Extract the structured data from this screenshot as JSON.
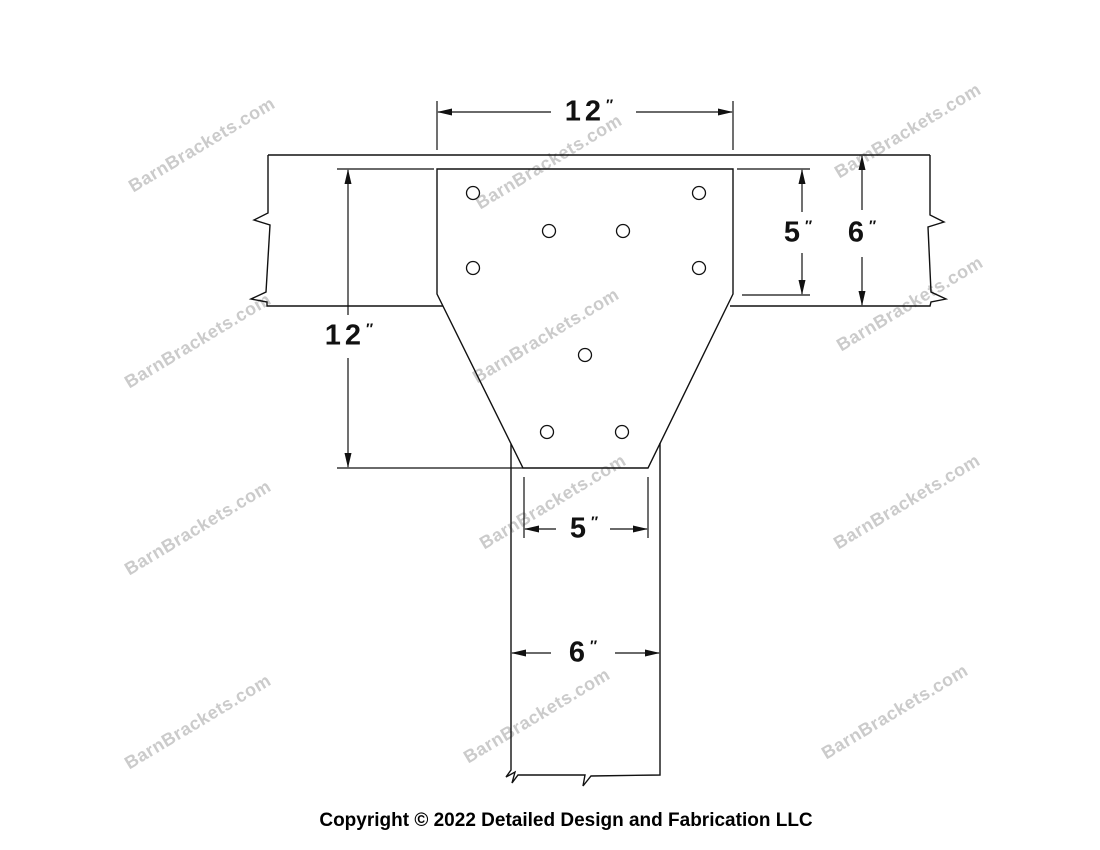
{
  "drawing": {
    "title_hint": "T-shaped barn bracket elevation drawing",
    "line_color": "#111111",
    "dimensions": {
      "top_width": {
        "value": "12",
        "unit": "″"
      },
      "left_height": {
        "value": "12",
        "unit": "″"
      },
      "right_plate_top": {
        "value": "5",
        "unit": "″"
      },
      "right_beam_height": {
        "value": "6",
        "unit": "″"
      },
      "bottom_plate_width": {
        "value": "5",
        "unit": "″"
      },
      "bottom_post_width": {
        "value": "6",
        "unit": "″"
      }
    },
    "holes": [
      {
        "x": 473,
        "y": 193
      },
      {
        "x": 699,
        "y": 193
      },
      {
        "x": 549,
        "y": 231
      },
      {
        "x": 623,
        "y": 231
      },
      {
        "x": 473,
        "y": 268
      },
      {
        "x": 699,
        "y": 268
      },
      {
        "x": 585,
        "y": 355
      },
      {
        "x": 547,
        "y": 432
      },
      {
        "x": 622,
        "y": 432
      }
    ]
  },
  "watermark": {
    "text": "BarnBrackets.com",
    "color": "#cbcbcb",
    "positions": [
      {
        "x": 202,
        "y": 145
      },
      {
        "x": 549,
        "y": 162
      },
      {
        "x": 908,
        "y": 131
      },
      {
        "x": 198,
        "y": 341
      },
      {
        "x": 546,
        "y": 336
      },
      {
        "x": 910,
        "y": 304
      },
      {
        "x": 198,
        "y": 528
      },
      {
        "x": 553,
        "y": 502
      },
      {
        "x": 907,
        "y": 502
      },
      {
        "x": 198,
        "y": 722
      },
      {
        "x": 537,
        "y": 716
      },
      {
        "x": 895,
        "y": 712
      }
    ]
  },
  "footer": {
    "copyright": "Copyright © 2022 Detailed Design and Fabrication LLC"
  }
}
